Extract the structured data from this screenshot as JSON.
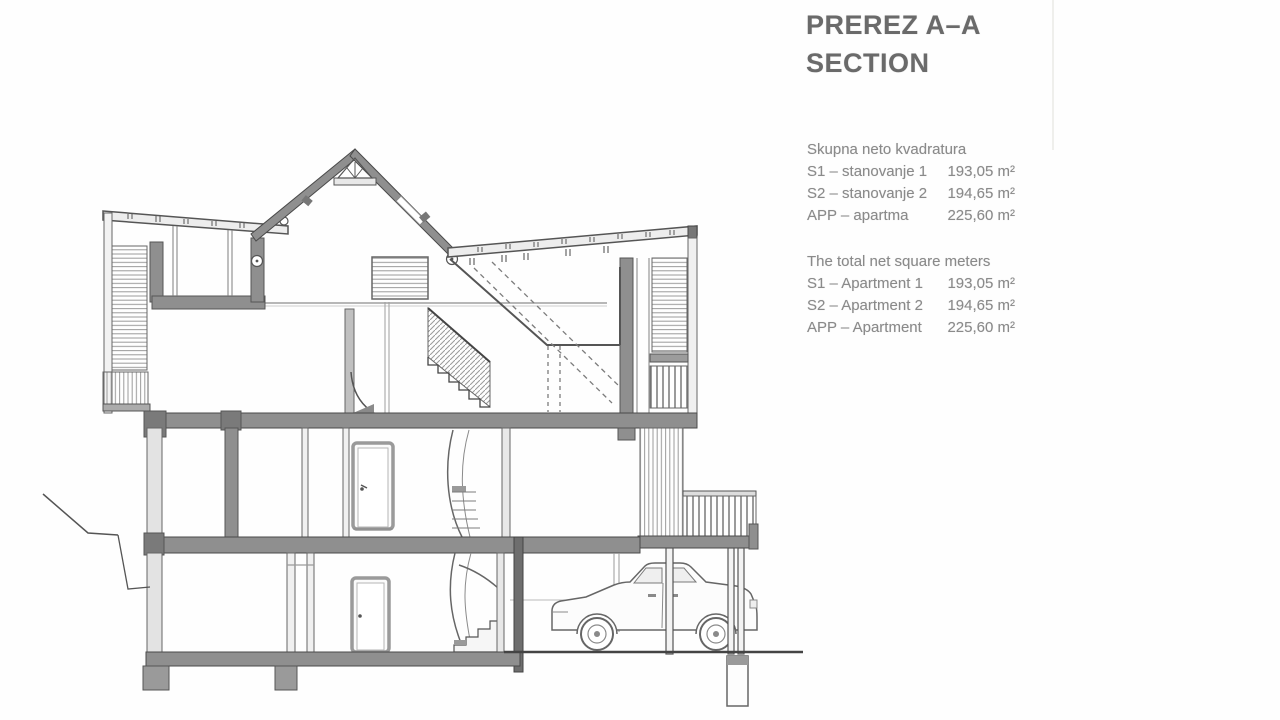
{
  "page": {
    "background_color": "#fefefe"
  },
  "title": {
    "line1": "PREREZ A–A",
    "line2": "SECTION"
  },
  "summary_sl": {
    "heading": "Skupna neto kvadratura",
    "rows": [
      {
        "label": "S1 – stanovanje 1",
        "value": "193,05 m²"
      },
      {
        "label": "S2 – stanovanje 2",
        "value": "194,65 m²"
      },
      {
        "label": "APP – apartma",
        "value": "225,60 m²"
      }
    ]
  },
  "summary_en": {
    "heading": "The total net square meters",
    "rows": [
      {
        "label": "S1 – Apartment 1",
        "value": "193,05 m²"
      },
      {
        "label": "S2 – Apartment 2",
        "value": "194,65 m²"
      },
      {
        "label": "APP – Apartment",
        "value": "225,60 m²"
      }
    ]
  },
  "drawing": {
    "type": "architectural-cross-section",
    "description": "Section A–A through a three-storey house: gable roof with king-post truss and skylight, attic with straight stair and louvered screens, middle floor with interior door and spiral stair, balcony with balustrade, garage level with door and steps, carport with parked sedan, foundations and terrain."
  }
}
